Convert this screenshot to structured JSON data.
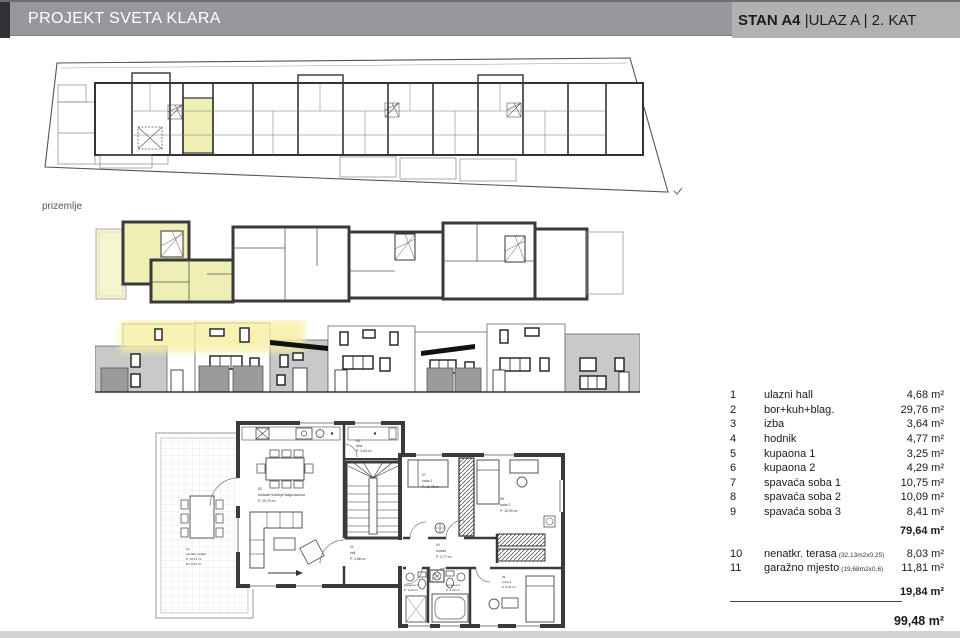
{
  "header": {
    "project_title": "PROJEKT SVETA KLARA",
    "unit_title_bold": "STAN A4 ",
    "unit_title_rest": "|ULAZ A | 2. KAT"
  },
  "colors": {
    "header_bg": "#98989c",
    "header_right_bg": "#b1b1b4",
    "highlight_yellow": "#edefb5",
    "wall_dark": "#3a3a3a",
    "facade_gray": "#c9c9c9",
    "garage_gray": "#9b9b9b"
  },
  "site_plan": {
    "caption": "prizemlje",
    "north_mark": "s"
  },
  "room_list": {
    "rooms": [
      {
        "num": "1",
        "name": "ulazni hall",
        "area": "4,68 m²"
      },
      {
        "num": "2",
        "name": "bor+kuh+blag.",
        "area": "29,76 m²"
      },
      {
        "num": "3",
        "name": "izba",
        "area": "3,64 m²"
      },
      {
        "num": "4",
        "name": "hodnik",
        "area": "4,77 m²"
      },
      {
        "num": "5",
        "name": "kupaona 1",
        "area": "3,25 m²"
      },
      {
        "num": "6",
        "name": "kupaona 2",
        "area": "4,29 m²"
      },
      {
        "num": "7",
        "name": "spavaća soba 1",
        "area": "10,75 m²"
      },
      {
        "num": "8",
        "name": "spavaća soba 2",
        "area": "10,09 m²"
      },
      {
        "num": "9",
        "name": "spavaća soba 3",
        "area": "8,41 m²"
      }
    ],
    "subtotal_main": "79,64 m²",
    "extras": [
      {
        "num": "10",
        "name": "nenatkr. terasa",
        "note": "(32,13m2x0,25)",
        "area": "8,03 m²"
      },
      {
        "num": "11",
        "name": "garažno mjesto",
        "note": "(19,68m2x0,6)",
        "area": "11,81 m²"
      }
    ],
    "subtotal_extras": "19,84 m²",
    "total": "99,48 m²"
  },
  "detail_plan": {
    "rooms": {
      "r01": {
        "id": "01",
        "name": "hall",
        "area": "P: 4,68 m²"
      },
      "r02": {
        "id": "02",
        "name": "boravak+kuhinja+blagovaonica",
        "area": "P: 29,76 m²"
      },
      "r03": {
        "id": "03",
        "name": "izba",
        "area": "P: 3,64 m²"
      },
      "r04": {
        "id": "04",
        "name": "hodnik",
        "area": "P: 4,77 m²"
      },
      "r05": {
        "id": "05",
        "name": "kupaona 1",
        "area": "P: 3,25 m²"
      },
      "r06": {
        "id": "06",
        "name": "kupaona 2",
        "area": "P: 4,29 m²"
      },
      "r07": {
        "id": "07",
        "name": "soba 1",
        "area": "P: 10,75 m²"
      },
      "r08": {
        "id": "08",
        "name": "soba 2",
        "area": "P: 10,09 m²"
      },
      "r09": {
        "id": "09",
        "name": "soba 3",
        "area": "P: 8,41 m²"
      },
      "r10": {
        "id": "10",
        "name": "nenatkr. terasa",
        "area": "P: 32,13 m²",
        "area2": "Ps: 8,03 m²"
      }
    }
  }
}
